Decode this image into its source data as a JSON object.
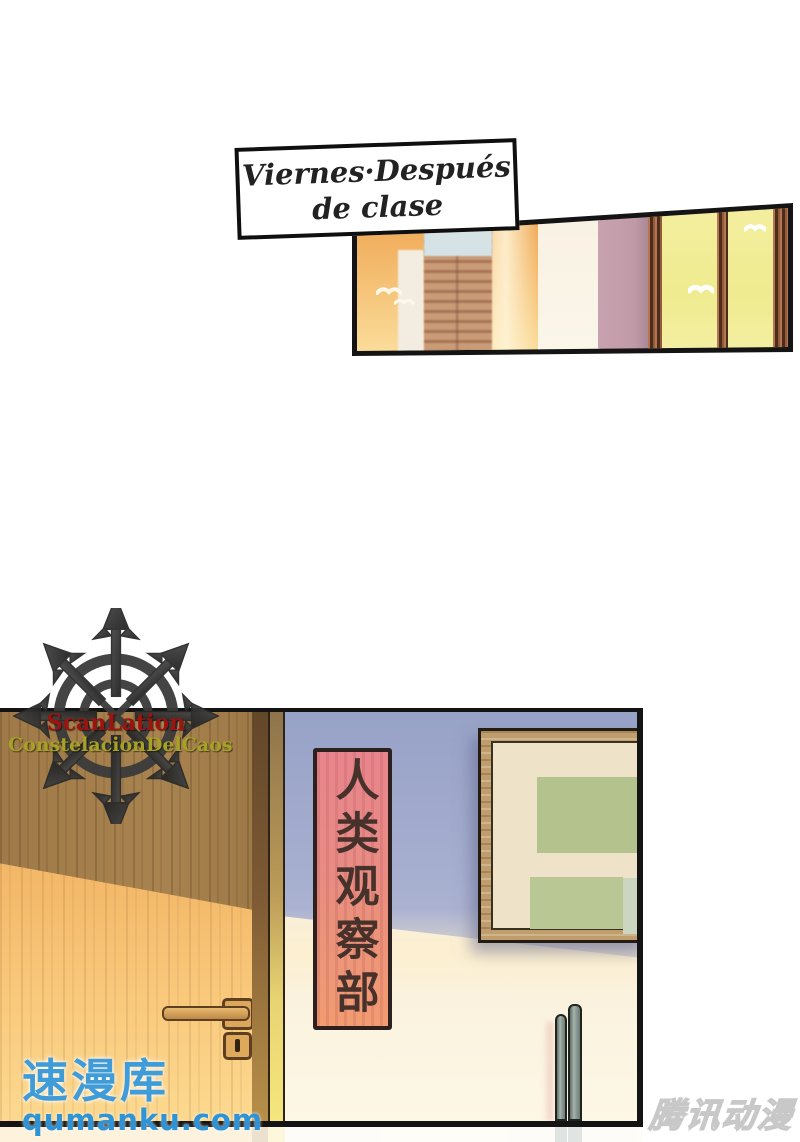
{
  "page": {
    "type": "manga-page",
    "background": "#ffffff"
  },
  "caption": {
    "line1": "Viernes·Después",
    "line2": "de clase"
  },
  "scanlation_logo": {
    "symbol": "chaos-star",
    "line1": "ScanLation",
    "line2": "ConstelacionDelCaos",
    "line1_color": "#9c1410",
    "line2_color": "#a6a226"
  },
  "panels": {
    "city_window": {
      "description": "city skyline at sunset seen past a window wall",
      "sky_top_color": "#eda24e",
      "sky_bottom_color": "#fbdf9d",
      "glass_color": "#efeb90",
      "frame_color": "#7c4a30",
      "white_column_color": "#f8f1e3",
      "mauve_column_color": "#c9a2af"
    },
    "hallway": {
      "description": "wooden door beside wall with red vertical club sign and bulletin board",
      "sign": {
        "text": "人类观察部",
        "bg_top": "#e8858d",
        "bg_bottom": "#f29c72",
        "text_color": "#46312b",
        "border_color": "#2c211f"
      },
      "door_light_color": "#f4ba6b",
      "door_shadow_color": "#a8834f",
      "wall_top_color": "#adb4d3",
      "wall_bottom_color": "#fdf7e6",
      "board_frame_color": "#bf9d6c",
      "board_mat_color": "#eee3c8",
      "board_papers": [
        "#b4c28e",
        "#b9c795",
        "#cbd5bf"
      ]
    }
  },
  "watermarks": {
    "qumanku": {
      "title": "速漫库",
      "url": "qumanku.com",
      "color": "#3f9cd8"
    },
    "tencent": {
      "text": "腾讯动漫"
    }
  }
}
